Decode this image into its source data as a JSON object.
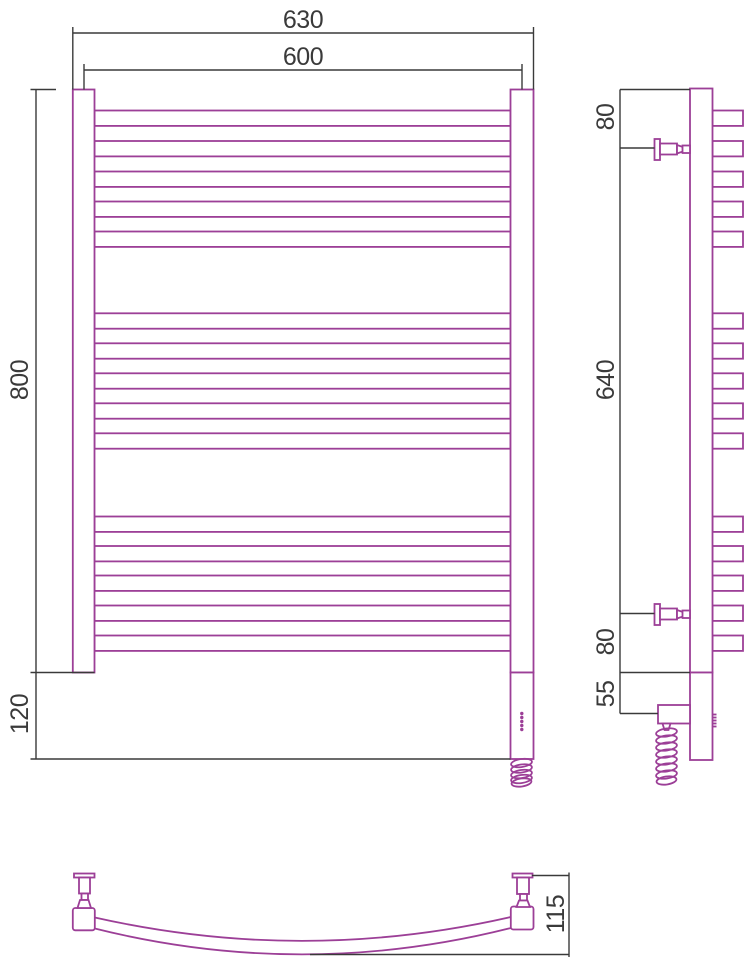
{
  "title": "Heated towel rail technical drawing (front, side and top views)",
  "colors": {
    "outline": "#9c3f97",
    "dimension_lines": "#3a3a3a",
    "background": "#ffffff"
  },
  "structure": {
    "rung_groups": 3,
    "rungs_per_group": 5,
    "total_rungs": 15,
    "features": [
      "wall-brackets",
      "electric-heating-element",
      "indicator-dots",
      "coiled-power-cable",
      "curved-rungs-top-view"
    ]
  },
  "views": {
    "front": {
      "dim_width_overall": "630",
      "dim_width_centers": "600",
      "dim_height_body": "800",
      "dim_height_bottom": "120"
    },
    "side": {
      "dim_top_offset": "80",
      "dim_bracket_span": "640",
      "dim_bottom_offset": "80",
      "dim_element_offset": "55"
    },
    "top": {
      "dim_depth": "115"
    }
  }
}
